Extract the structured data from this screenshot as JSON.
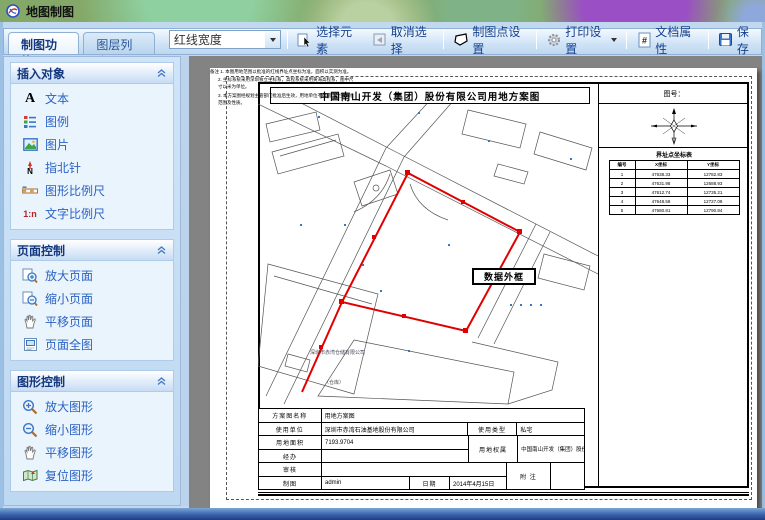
{
  "window": {
    "title": "地图制图"
  },
  "tabs": {
    "function": "制图功能",
    "layers": "图层列表"
  },
  "toolbar": {
    "line_width_combo": "红线宽度",
    "select_element": "选择元素",
    "cancel_select": "取消选择",
    "plot_point_settings": "制图点设置",
    "print_settings": "打印设置",
    "doc_properties": "文档属性",
    "save": "保存"
  },
  "icons": {
    "text_letter": "A",
    "ratio": "1:n",
    "north_letter": "N"
  },
  "sidebar": {
    "sections": [
      {
        "title": "插入对象",
        "items": [
          {
            "label": "文本"
          },
          {
            "label": "图例"
          },
          {
            "label": "图片"
          },
          {
            "label": "指北针"
          },
          {
            "label": "图形比例尺"
          },
          {
            "label": "文字比例尺"
          }
        ]
      },
      {
        "title": "页面控制",
        "items": [
          {
            "label": "放大页面"
          },
          {
            "label": "缩小页面"
          },
          {
            "label": "平移页面"
          },
          {
            "label": "页面全图"
          }
        ]
      },
      {
        "title": "图形控制",
        "items": [
          {
            "label": "放大图形"
          },
          {
            "label": "缩小图形"
          },
          {
            "label": "平移图形"
          },
          {
            "label": "复位图形"
          }
        ]
      }
    ]
  },
  "document": {
    "sheet_title": "中国南山开发（集团）股份有限公司用地方案图",
    "figure_no": "图号：",
    "selected_label": "数据外框",
    "coord_table": {
      "title": "界址点坐标表",
      "headers": [
        "编号",
        "X坐标",
        "Y坐标"
      ],
      "rows": [
        [
          "1",
          "47638.33",
          "12782.83"
        ],
        [
          "2",
          "47631.98",
          "12688.93"
        ],
        [
          "3",
          "47612.74",
          "12735.21"
        ],
        [
          "4",
          "47648.58",
          "12727.08"
        ],
        [
          "5",
          "47680.81",
          "12790.84"
        ]
      ]
    },
    "map_labels": {
      "parcel1": "深圳市赤湾仓储有限公司",
      "parcel2": "（仓库）"
    },
    "notes": {
      "line1": "备注  1. 本图用地范围以批准的红线界址点坐标为准，面积以实测为准。",
      "line2": "2. 坐标系统采用深圳独立坐标系，高程系统采用黄海高程系，图中尺寸以米为单位。",
      "line3": "3. 本方案图经规划主管部门批准后生效，用地单位不得擅自改变用地范围及性质。"
    },
    "form": {
      "r1_label": "方案图名称",
      "r1_value": "用地方案图",
      "r2_label": "使用单位",
      "r2_value": "深圳市赤湾石油基地股份有限公司",
      "r2_label2": "使用类型",
      "r2_value2": "私宅",
      "r3_label": "用地面积",
      "r3_value": "7193.9704",
      "r3_label2": "用地权属",
      "r3_value2": "中国南山开发（集团）股份有限公司",
      "r4_label": "经办",
      "r4_value": "",
      "r5_label": "审核",
      "r5_value": "",
      "r5_label2": "附  注",
      "r5_value2": "",
      "r6_label": "制图",
      "r6_value": "admin",
      "r6_label2": "日期",
      "r6_value2": "2014年4月15日"
    }
  }
}
